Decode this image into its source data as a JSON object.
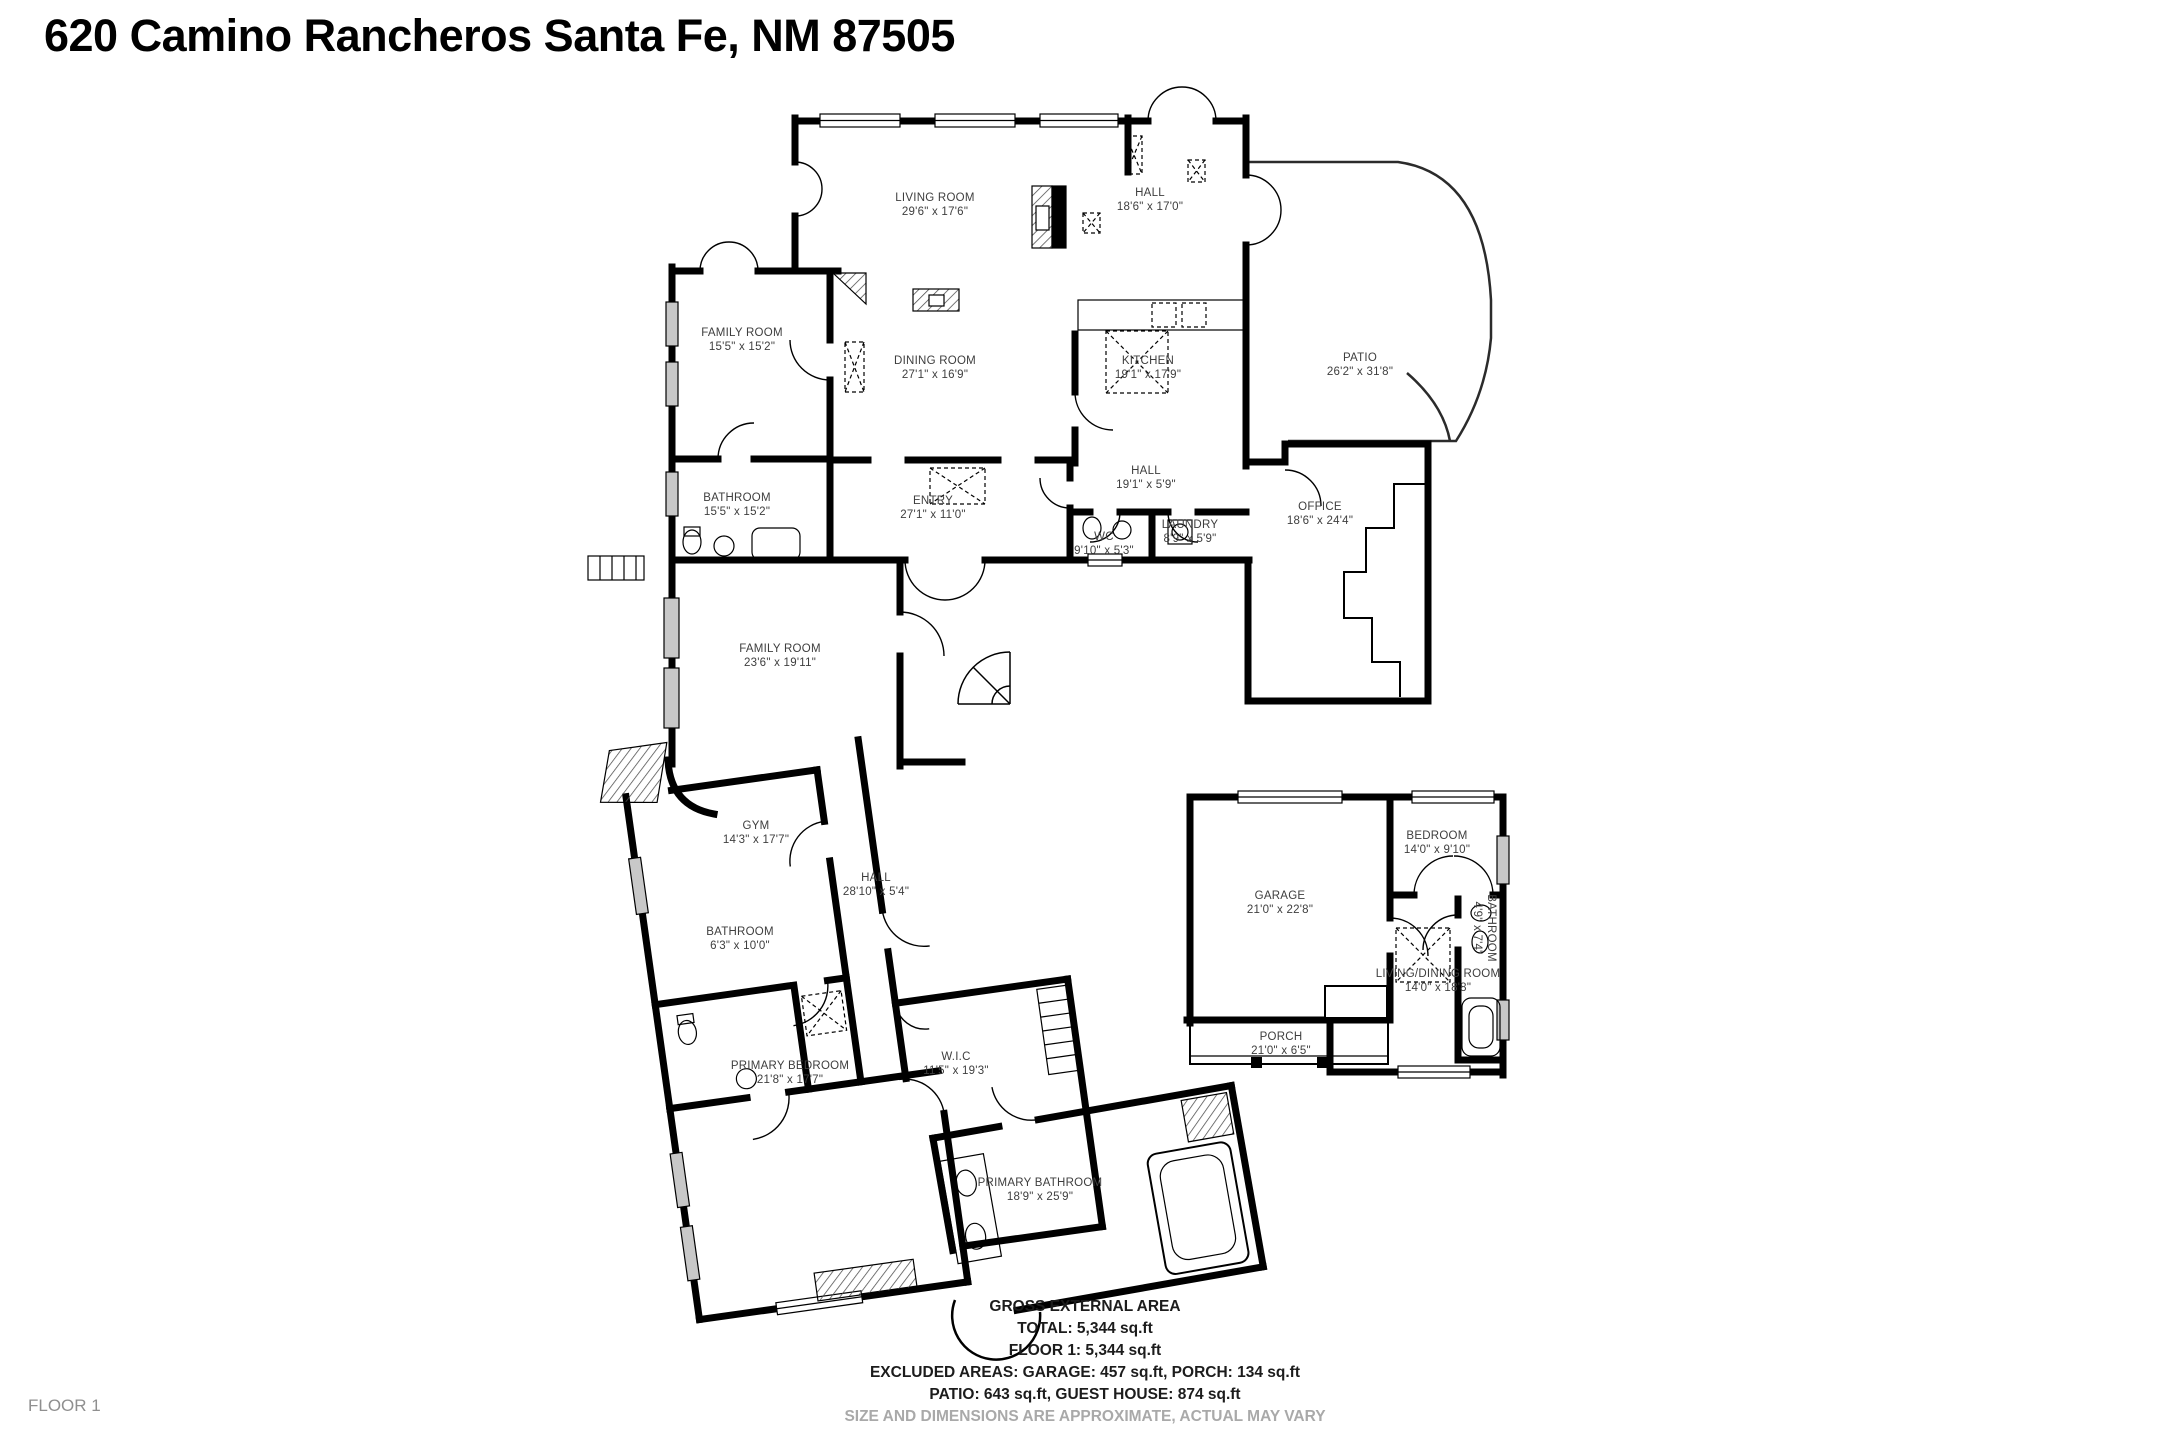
{
  "title": "620 Camino Rancheros Santa Fe, NM 87505",
  "floor_label": "FLOOR 1",
  "rooms": [
    {
      "id": "living-room",
      "name": "LIVING ROOM",
      "dims": "29'6\" x 17'6\"",
      "x": 935,
      "y": 205
    },
    {
      "id": "hall-top",
      "name": "HALL",
      "dims": "18'6\" x 17'0\"",
      "x": 1150,
      "y": 200
    },
    {
      "id": "family-room-top",
      "name": "FAMILY ROOM",
      "dims": "15'5\" x 15'2\"",
      "x": 742,
      "y": 340
    },
    {
      "id": "dining-room",
      "name": "DINING ROOM",
      "dims": "27'1\" x 16'9\"",
      "x": 935,
      "y": 368
    },
    {
      "id": "kitchen",
      "name": "KITCHEN",
      "dims": "19'1\" x 17'9\"",
      "x": 1148,
      "y": 368
    },
    {
      "id": "patio",
      "name": "PATIO",
      "dims": "26'2\" x 31'8\"",
      "x": 1360,
      "y": 365
    },
    {
      "id": "bathroom-upper",
      "name": "BATHROOM",
      "dims": "15'5\" x 15'2\"",
      "x": 737,
      "y": 505
    },
    {
      "id": "entry",
      "name": "ENTRY",
      "dims": "27'1\" x 11'0\"",
      "x": 933,
      "y": 508
    },
    {
      "id": "hall-mid",
      "name": "HALL",
      "dims": "19'1\" x 5'9\"",
      "x": 1146,
      "y": 478
    },
    {
      "id": "wc",
      "name": "WC",
      "dims": "9'10\" x 5'3\"",
      "x": 1104,
      "y": 544
    },
    {
      "id": "laundry",
      "name": "LAUNDRY",
      "dims": "8'9\" x 5'9\"",
      "x": 1190,
      "y": 532
    },
    {
      "id": "office",
      "name": "OFFICE",
      "dims": "18'6\" x 24'4\"",
      "x": 1320,
      "y": 514
    },
    {
      "id": "family-room-lower",
      "name": "FAMILY ROOM",
      "dims": "23'6\" x 19'11\"",
      "x": 780,
      "y": 656
    },
    {
      "id": "gym",
      "name": "GYM",
      "dims": "14'3\" x 17'7\"",
      "x": 756,
      "y": 833
    },
    {
      "id": "hall-lower",
      "name": "HALL",
      "dims": "28'10\" x 5'4\"",
      "x": 876,
      "y": 885
    },
    {
      "id": "bathroom-lower",
      "name": "BATHROOM",
      "dims": "6'3\" x 10'0\"",
      "x": 740,
      "y": 939
    },
    {
      "id": "primary-bedroom",
      "name": "PRIMARY BEDROOM",
      "dims": "21'8\" x 17'7\"",
      "x": 790,
      "y": 1073
    },
    {
      "id": "wic",
      "name": "W.I.C",
      "dims": "11'5\" x 19'3\"",
      "x": 956,
      "y": 1064
    },
    {
      "id": "primary-bathroom",
      "name": "PRIMARY BATHROOM",
      "dims": "18'9\" x 25'9\"",
      "x": 1040,
      "y": 1190
    },
    {
      "id": "garage",
      "name": "GARAGE",
      "dims": "21'0\" x 22'8\"",
      "x": 1280,
      "y": 903
    },
    {
      "id": "bedroom-guest",
      "name": "BEDROOM",
      "dims": "14'0\" x 9'10\"",
      "x": 1437,
      "y": 843
    },
    {
      "id": "bathroom-guest",
      "name": "BATHROOM",
      "dims": "4'9\" x 7'4\"",
      "x": 1484,
      "y": 928,
      "rotated": true
    },
    {
      "id": "living-dining-room",
      "name": "LIVING/DINING ROOM",
      "dims": "14'0\" x 18'8\"",
      "x": 1438,
      "y": 981
    },
    {
      "id": "porch",
      "name": "PORCH",
      "dims": "21'0\" x 6'5\"",
      "x": 1281,
      "y": 1044
    }
  ],
  "summary": {
    "heading": "GROSS EXTERNAL AREA",
    "lines": [
      "TOTAL: 5,344 sq.ft",
      "FLOOR 1: 5,344 sq.ft",
      "EXCLUDED AREAS: GARAGE: 457 sq.ft, PORCH: 134 sq.ft",
      "PATIO: 643 sq.ft, GUEST HOUSE: 874 sq.ft"
    ],
    "disclaimer": "SIZE AND DIMENSIONS ARE APPROXIMATE, ACTUAL MAY VARY"
  },
  "colors": {
    "wall": "#000000",
    "label_text": "#3e3e3e",
    "muted_text": "#a9a9a9",
    "window_fill": "#c8c8c8"
  }
}
